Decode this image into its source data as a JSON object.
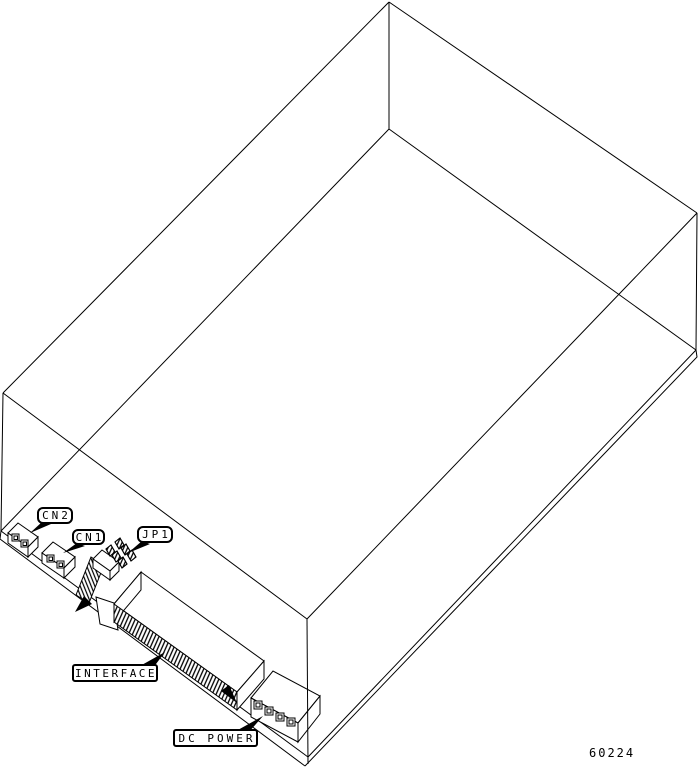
{
  "figure": {
    "part_number": "60224",
    "background_color": "#ffffff",
    "line_color": "#000000",
    "callouts": {
      "cn2": {
        "label": "CN2"
      },
      "cn1": {
        "label": "CN1"
      },
      "jp1": {
        "label": "JP1"
      },
      "interface": {
        "label": "INTERFACE"
      },
      "dc_power": {
        "label": "DC POWER"
      }
    }
  }
}
